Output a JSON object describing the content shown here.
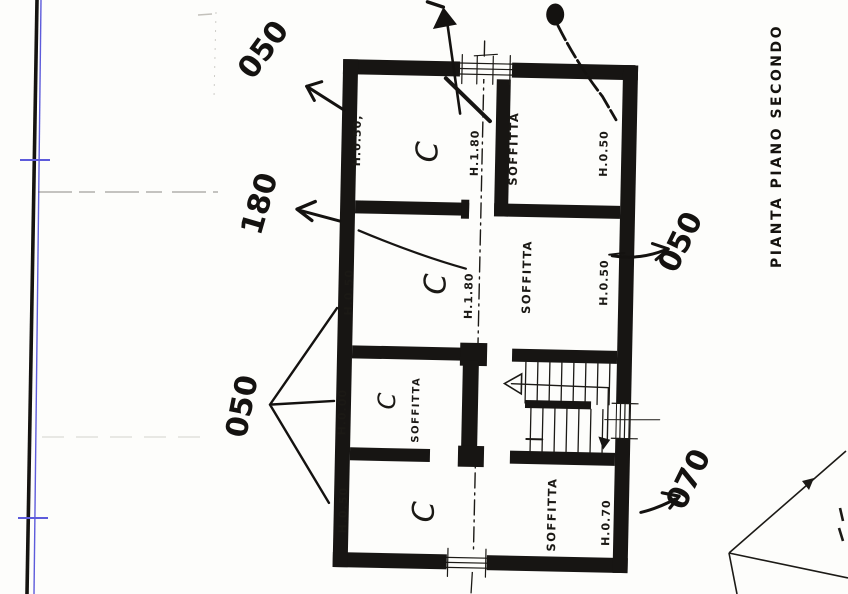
{
  "ink_color": "#171513",
  "accent_blue": "#5d5bdb",
  "title": {
    "vertical_label": "PIANTA PIANO SECONDO"
  },
  "arrows": {
    "top_left": "050",
    "left": "180",
    "right": "050",
    "bottom_left": "050",
    "bottom_right": "070"
  },
  "rooms": {
    "top_left": {
      "height": "H.0.50,",
      "mark": "C"
    },
    "top_axis_height": "H.1.80",
    "top_right": {
      "name": "SOFFITTA",
      "height": "H.0.50"
    },
    "mid_left": {
      "height": "H.0.50",
      "mark": "C"
    },
    "mid_axis_height": "H.1.80",
    "mid_right": {
      "name": "SOFFITTA",
      "height": "H.0.50"
    },
    "small": {
      "name": "SOFFITTA",
      "height": "H.0.00",
      "mark": "C"
    },
    "bottom": {
      "name": "SOFFITTA",
      "height_left": "H.0.50",
      "height_right": "H.0.70",
      "mark": "C"
    }
  }
}
